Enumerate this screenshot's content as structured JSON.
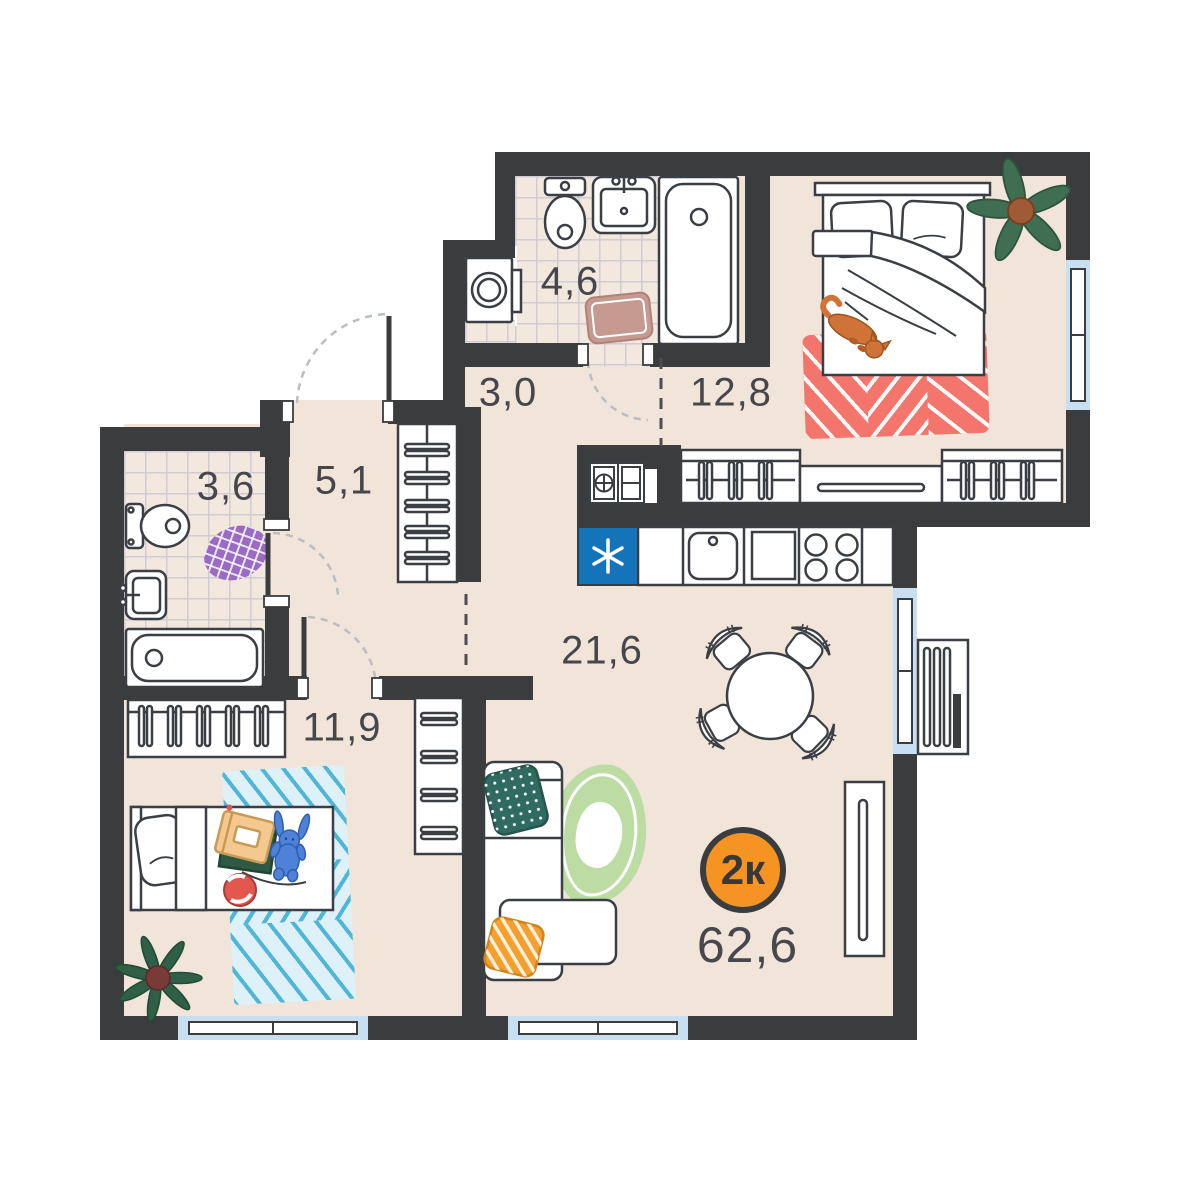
{
  "plan": {
    "type": "apartment-floor-plan",
    "badge": {
      "label": "2к",
      "total_area": "62,6"
    },
    "colors": {
      "badge_orange": "#f59422",
      "wall": "#3a3c3d",
      "floor": "#f1e5da",
      "window_blue": "#c8def1",
      "fridge_blue": "#1474ba"
    },
    "rooms": [
      {
        "name": "bathroom",
        "area": "4,6"
      },
      {
        "name": "hallway",
        "area": "3,0"
      },
      {
        "name": "bedroom",
        "area": "12,8"
      },
      {
        "name": "corridor",
        "area": "5,1"
      },
      {
        "name": "bathroom-small",
        "area": "3,6"
      },
      {
        "name": "kids-room",
        "area": "11,9"
      },
      {
        "name": "living-kitchen",
        "area": "21,6"
      }
    ]
  }
}
